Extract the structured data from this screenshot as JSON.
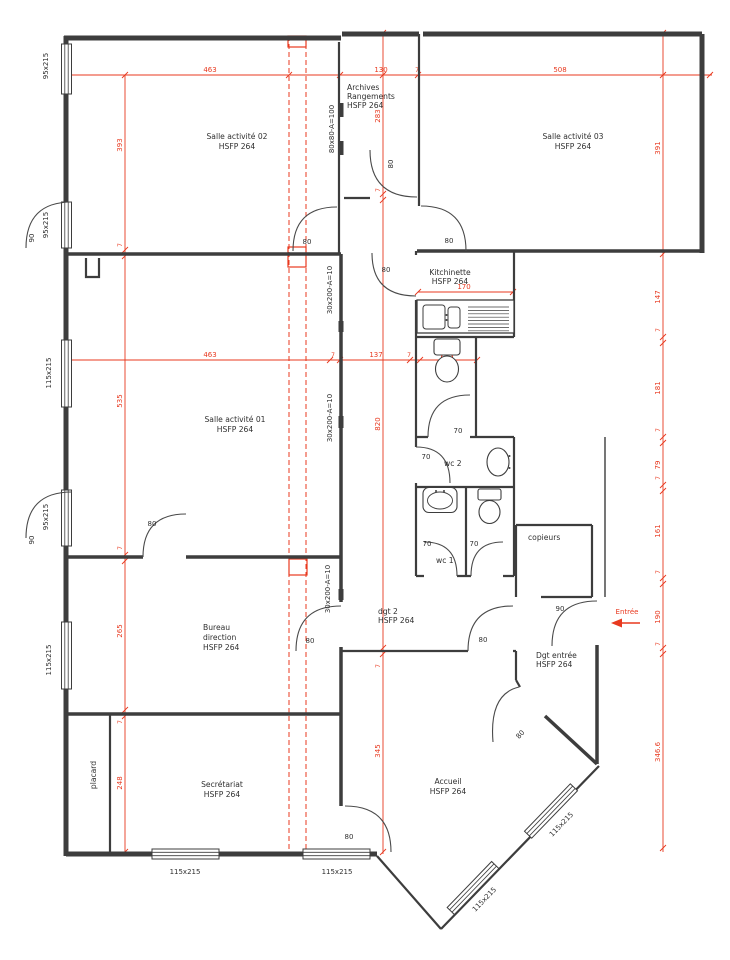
{
  "colors": {
    "dim": "#e8391f",
    "wall": "#3d3d3d",
    "text": "#2f2f2f"
  },
  "rooms": {
    "salle02": {
      "name": "Salle activité 02",
      "hsfp": "HSFP 264"
    },
    "salle03": {
      "name": "Salle activité 03",
      "hsfp": "HSFP 264"
    },
    "salle01": {
      "name": "Salle activité 01",
      "hsfp": "HSFP 264"
    },
    "archives": {
      "l1": "Archives",
      "l2": "Rangements",
      "hsfp": "HSFP 264"
    },
    "kitchinette": {
      "name": "Kitchinette",
      "hsfp": "HSFP 264"
    },
    "bureau": {
      "l1": "Bureau",
      "l2": "direction",
      "hsfp": "HSFP 264"
    },
    "secretariat": {
      "name": "Secrétariat",
      "hsfp": "HSFP 264"
    },
    "accueil": {
      "name": "Accueil",
      "hsfp": "HSFP 264"
    },
    "dgt2": {
      "name": "dgt 2",
      "hsfp": "HSFP 264"
    },
    "dgt_entree": {
      "name": "Dgt entrée",
      "hsfp": "HSFP 264"
    },
    "copieurs": {
      "name": "copieurs"
    },
    "wc1": {
      "name": "wc 1"
    },
    "wc2": {
      "name": "wc 2"
    },
    "placard": {
      "name": "placard"
    }
  },
  "dims": {
    "top_463": "463",
    "top_130": "130",
    "top_7": "7",
    "top_508": "508",
    "mid_463": "463",
    "mid_7a": "7",
    "mid_137": "137",
    "mid_7b": "7",
    "mid_65": "65",
    "kitchen_170": "170",
    "left_393": "393",
    "left_7a": "7",
    "left_535": "535",
    "left_7b": "7",
    "left_265": "265",
    "left_7c": "7",
    "left_248": "248",
    "center_283": "283",
    "center_7a": "7",
    "center_820": "820",
    "center_7b": "7",
    "center_345": "345",
    "right_391": "391",
    "right_147": "147",
    "right_7a": "7",
    "right_181": "181",
    "right_7b": "7",
    "right_79": "79",
    "right_7c": "7",
    "right_161": "161",
    "right_7d": "7",
    "right_190": "190",
    "right_7e": "7",
    "right_3466": "346.6"
  },
  "doors": {
    "w80": "80",
    "w70": "70",
    "w90": "90"
  },
  "windows": {
    "w95": "95x215",
    "w115": "115x215"
  },
  "marks": {
    "hatch": "80x80-A=100",
    "glazing": "30x200-A=10"
  },
  "entry": {
    "label": "Entrée"
  }
}
